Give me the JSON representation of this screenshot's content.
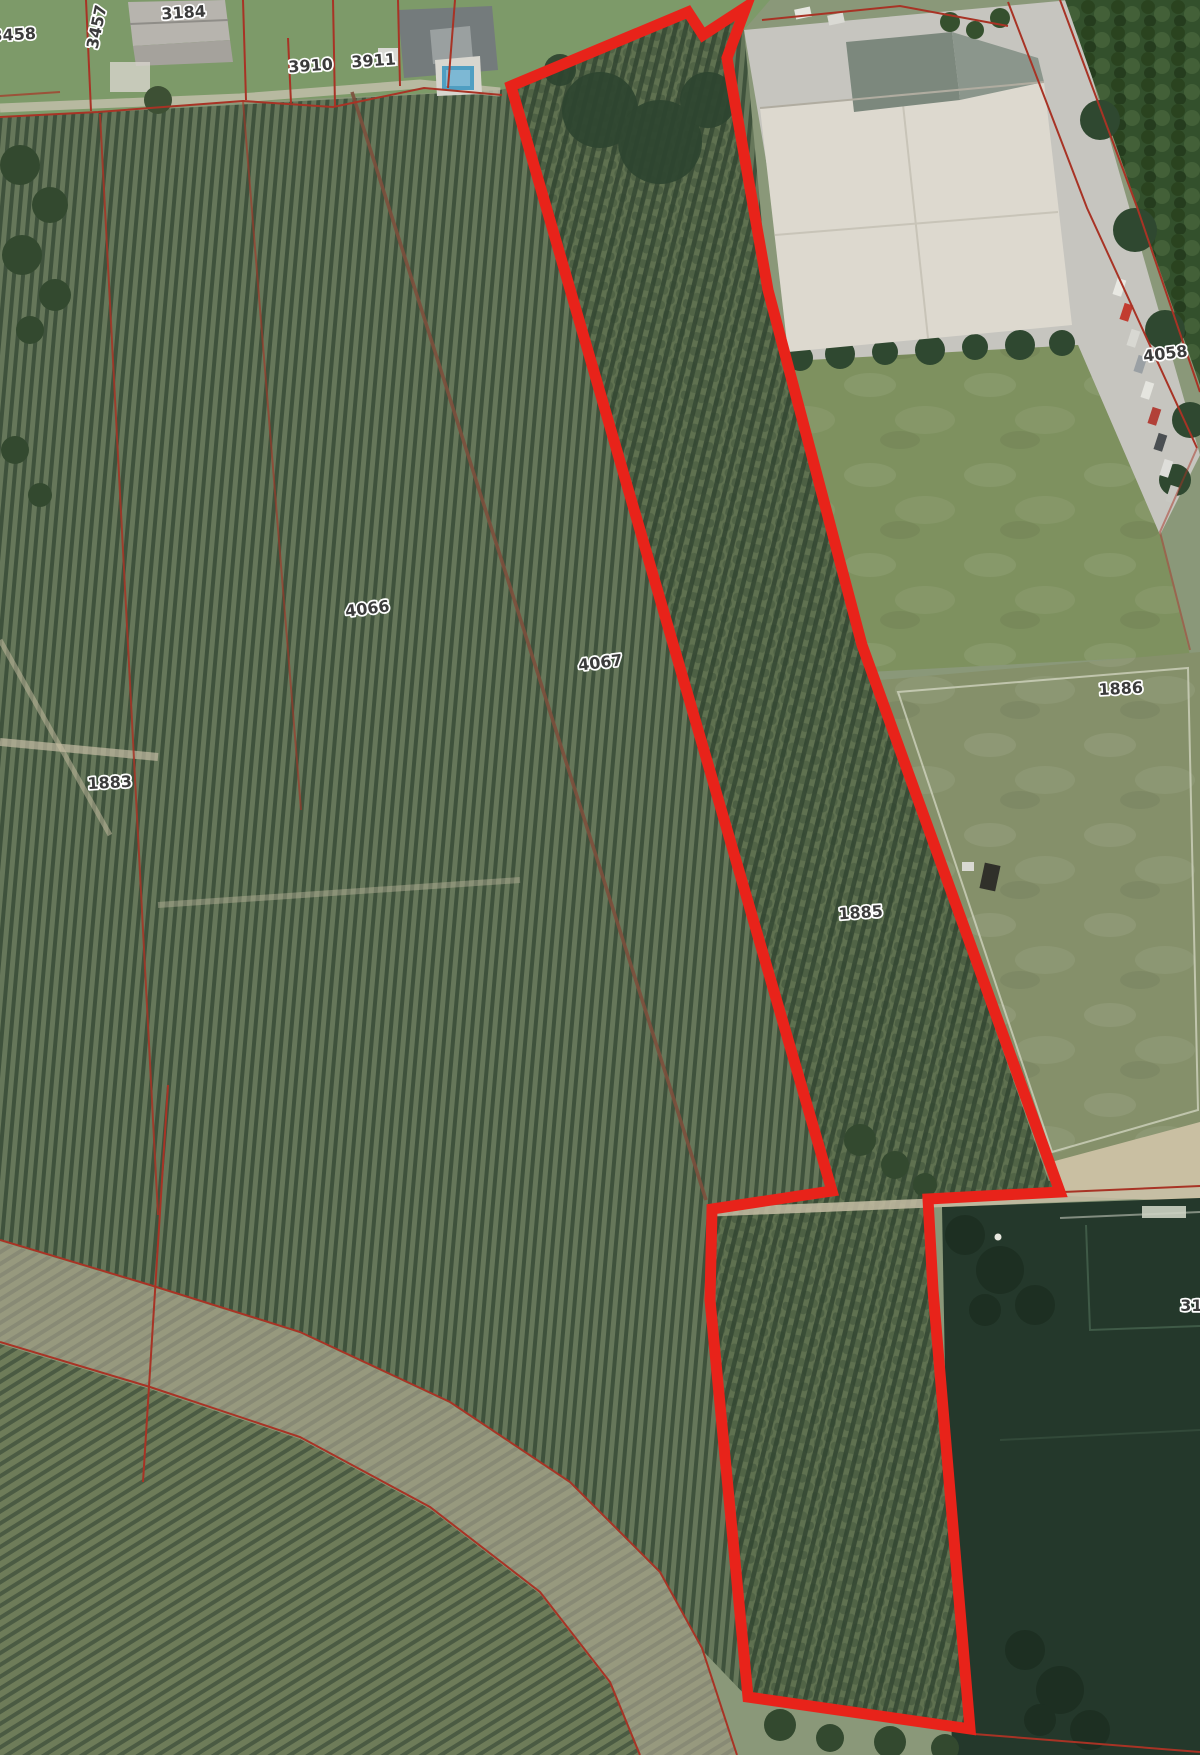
{
  "map": {
    "type": "aerial-cadastral-map",
    "description": "Aerial orthophoto with cadastral parcel boundaries and a red highlighted parcel group",
    "labels": [
      {
        "text": "3458"
      },
      {
        "text": "3457"
      },
      {
        "text": "3184"
      },
      {
        "text": "3910"
      },
      {
        "text": "3911"
      },
      {
        "text": "4058"
      },
      {
        "text": "4066"
      },
      {
        "text": "4067"
      },
      {
        "text": "1883"
      },
      {
        "text": "1885"
      },
      {
        "text": "1886"
      },
      {
        "text": "311"
      }
    ],
    "highlighted_parcels": [
      "4067",
      "1885"
    ],
    "colors": {
      "highlight_outline": "#e8231a",
      "cadastral_line": "#a83325",
      "label_text": "#3b3b3b",
      "label_halo": "#ffffff"
    }
  }
}
